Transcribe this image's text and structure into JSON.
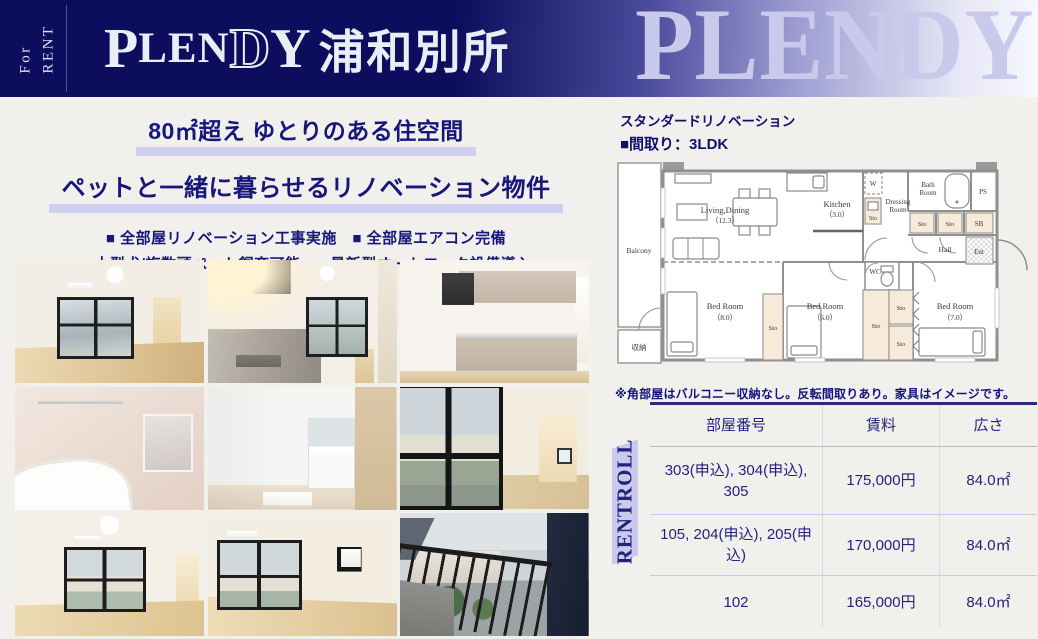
{
  "header": {
    "for_rent": {
      "line1": "For",
      "line2": "RENT"
    },
    "logo": {
      "p": "P",
      "len": "LEN",
      "d": "D",
      "y": "Y",
      "jp": "浦和別所"
    },
    "watermark": "PLENDY"
  },
  "hero": {
    "headline1": "80㎡超え ゆとりのある住空間",
    "headline2": "ペットと一緒に暮らせるリノベーション物件",
    "features": [
      "■ 全部屋リノベーション工事実施　■ 全部屋エアコン完備",
      "■ 大型犬/複数頭ペット飼育可能　■ 最新型オートロック設備導入"
    ]
  },
  "floorplan": {
    "subtitle": "スタンダードリノベーション",
    "layout_title": "■間取り：3LDK",
    "note": "※角部屋はバルコニー収納なし。反転間取りあり。家具はイメージです。",
    "labels": {
      "balcony": "Balcony",
      "closet": "収納",
      "living": "Living,Dining",
      "living_size": "（12.3）",
      "kitchen": "Kitchen",
      "kitchen_size": "（3.0）",
      "washer": "W",
      "dressing_line1": "Dressing",
      "dressing_line2": "Room",
      "bath_line1": "Bath",
      "bath_line2": "Room",
      "ps": "PS",
      "sb": "SB",
      "sto": "Sto",
      "hall": "Hall",
      "ent": "Ent",
      "wc": "WC",
      "bed8": "Bed Room",
      "bed8_size": "（8.0）",
      "bed6": "Bed Room",
      "bed6_size": "（6.0）",
      "bed7": "Bed Room",
      "bed7_size": "（7.0）"
    }
  },
  "rentroll": {
    "vertical_label": "RENTROLL",
    "columns": [
      "部屋番号",
      "賃料",
      "広さ"
    ],
    "rows": [
      {
        "rooms": "303(申込), 304(申込), 305",
        "rent": "175,000円",
        "area": "84.0㎡"
      },
      {
        "rooms": "105, 204(申込), 205(申込)",
        "rent": "170,000円",
        "area": "84.0㎡"
      },
      {
        "rooms": "102",
        "rent": "165,000円",
        "area": "84.0㎡"
      }
    ]
  },
  "colors": {
    "header_navy": "#0d0d5d",
    "text_navy": "#16167b",
    "highlight_lavender": "#cfcff2",
    "band_lavender": "#cacaee"
  }
}
